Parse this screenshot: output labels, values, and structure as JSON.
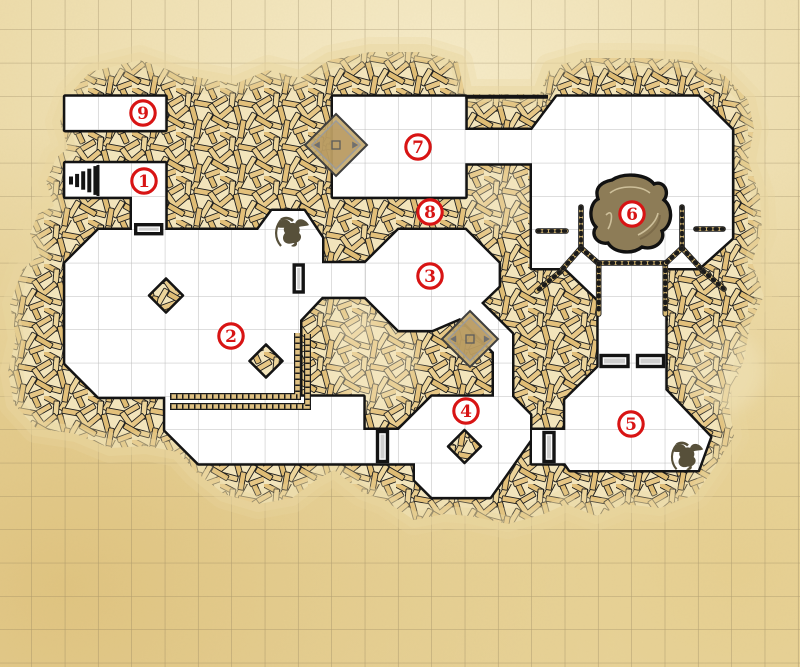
{
  "map": {
    "kind": "dungeon-battle-map",
    "room_count": 9,
    "grid": {
      "cell_px": 33.33,
      "offset_x": 32,
      "offset_y": 30
    }
  },
  "colors": {
    "parchment": "#ead7a1",
    "parchment_light": "#f6ebc8",
    "parchment_dark": "#dfc27e",
    "outer_grid": "#8a7a58",
    "room_grid": "#bcbcbc",
    "room_floor": "#ffffff",
    "wall_line": "#141414",
    "hatch_gap": "#f2e4bb",
    "hatch_plank": "#e3c07a",
    "marker_red": "#d81414",
    "pond_fill": "#8d7c57",
    "platform_fill": "#c3a76b",
    "creature_fill": "#57503a",
    "fence_tan": "#d9ba74",
    "door_inner": "#cfcfcf"
  },
  "markers": [
    {
      "label": "1",
      "x": 144,
      "y": 181
    },
    {
      "label": "2",
      "x": 231,
      "y": 336
    },
    {
      "label": "3",
      "x": 430,
      "y": 276
    },
    {
      "label": "4",
      "x": 466,
      "y": 411
    },
    {
      "label": "5",
      "x": 631,
      "y": 424
    },
    {
      "label": "6",
      "x": 632,
      "y": 214
    },
    {
      "label": "7",
      "x": 418,
      "y": 147
    },
    {
      "label": "8",
      "x": 430,
      "y": 212
    },
    {
      "label": "9",
      "x": 143,
      "y": 113
    }
  ],
  "features": {
    "stairs": {
      "x": 68,
      "y": 166,
      "w": 32,
      "h": 29,
      "steps": 5
    },
    "doors": [
      {
        "id": "door-room1-south",
        "orient": "h",
        "x": 148.7,
        "y": 229.2,
        "w": 26,
        "h": 9
      },
      {
        "id": "door-room2-east",
        "orient": "v",
        "x": 298.7,
        "y": 278.5,
        "w": 9,
        "h": 27
      },
      {
        "id": "door-room4-west",
        "orient": "v",
        "x": 382.5,
        "y": 446.5,
        "w": 10,
        "h": 30
      },
      {
        "id": "door-room5-west",
        "orient": "v",
        "x": 549,
        "y": 447,
        "w": 10,
        "h": 29
      },
      {
        "id": "door-passage-a",
        "orient": "h",
        "x": 614.5,
        "y": 361,
        "w": 27,
        "h": 11
      },
      {
        "id": "door-passage-b",
        "orient": "h",
        "x": 650.5,
        "y": 361,
        "w": 26,
        "h": 11
      }
    ],
    "pillars": [
      {
        "x": 166,
        "y": 295.5,
        "r": 17
      },
      {
        "x": 266,
        "y": 361,
        "r": 16.5
      },
      {
        "x": 464.5,
        "y": 446.5,
        "r": 16.5
      }
    ],
    "platforms": [
      {
        "x": 336,
        "y": 145,
        "r": 31
      },
      {
        "x": 470,
        "y": 339,
        "r": 28
      }
    ],
    "pond": {
      "x": 632,
      "y": 213
    },
    "creatures": [
      {
        "x": 293,
        "y": 233,
        "scale": 1.0
      },
      {
        "x": 688,
        "y": 457,
        "scale": 0.95
      }
    ],
    "fences": [
      [
        581,
        207,
        581,
        248
      ],
      [
        581,
        248,
        560,
        272
      ],
      [
        560,
        272,
        537,
        291
      ],
      [
        581,
        248,
        598,
        263
      ],
      [
        538,
        231,
        566,
        231
      ],
      [
        598.7,
        263,
        665.3,
        263
      ],
      [
        598.7,
        263,
        598.7,
        314
      ],
      [
        665.3,
        263,
        665.3,
        314
      ],
      [
        682,
        207,
        682,
        248
      ],
      [
        682,
        248,
        703,
        271
      ],
      [
        703,
        271,
        724,
        289
      ],
      [
        682,
        248,
        666,
        263
      ],
      [
        696,
        229,
        723,
        229
      ]
    ],
    "ledges": [
      "M170,396.5 H297.5 V333",
      "M170,406.5 H307.5 V334"
    ]
  }
}
